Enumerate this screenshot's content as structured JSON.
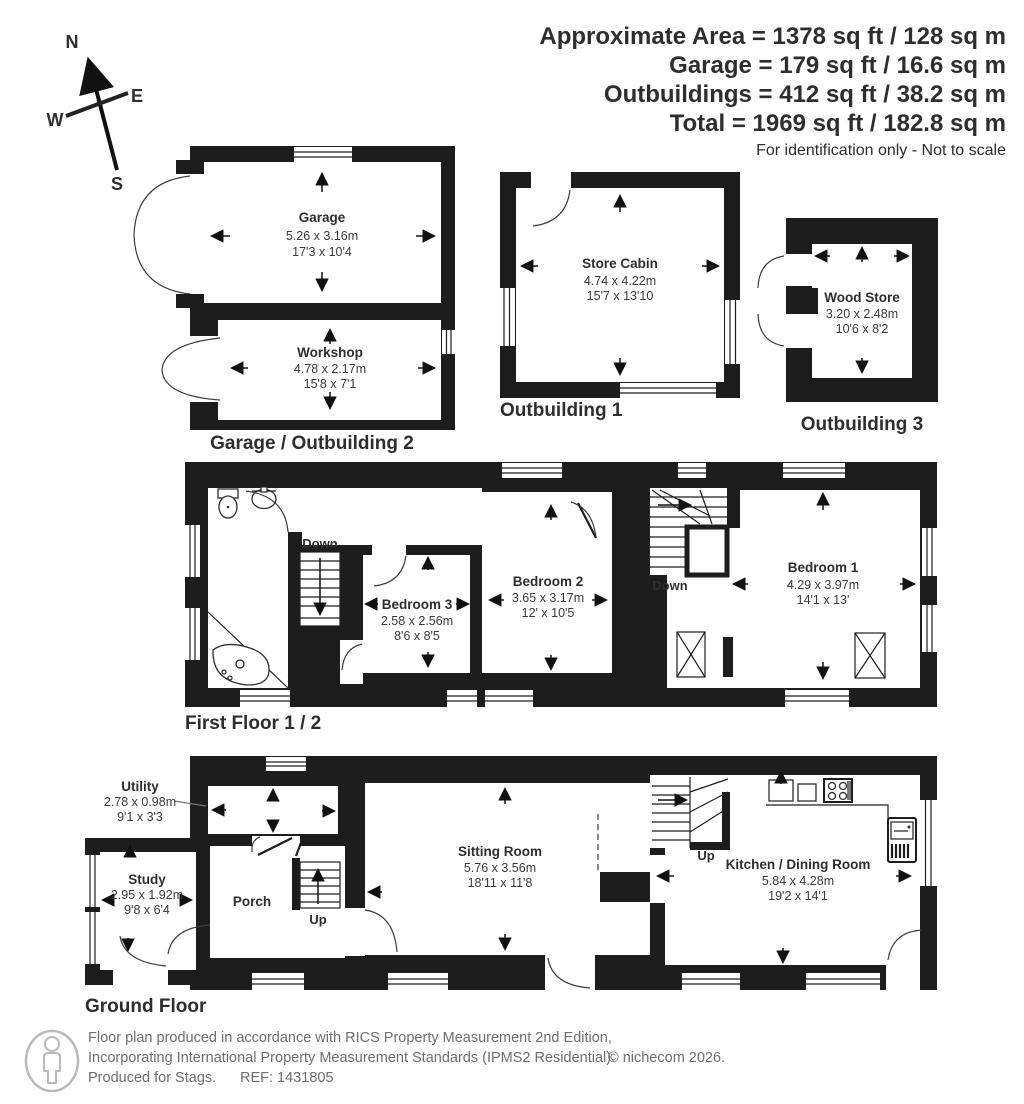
{
  "header": {
    "line1": "Approximate Area = 1378 sq ft / 128 sq m",
    "line2": "Garage = 179 sq ft / 16.6 sq m",
    "line3": "Outbuildings = 412 sq ft / 38.2 sq m",
    "line4": "Total = 1969 sq ft / 182.8 sq m",
    "disclaimer": "For identification only - Not to scale"
  },
  "compass": {
    "north": "N",
    "east": "E",
    "south": "S",
    "west": "W"
  },
  "garage_block": {
    "label": "Garage / Outbuilding 2",
    "garage": {
      "name": "Garage",
      "metric": "5.26 x 3.16m",
      "imperial": "17'3 x 10'4"
    },
    "workshop": {
      "name": "Workshop",
      "metric": "4.78 x 2.17m",
      "imperial": "15'8 x 7'1"
    }
  },
  "outbuilding1": {
    "label": "Outbuilding 1",
    "store_cabin": {
      "name": "Store Cabin",
      "metric": "4.74 x 4.22m",
      "imperial": "15'7 x 13'10"
    }
  },
  "outbuilding3": {
    "label": "Outbuilding 3",
    "wood_store": {
      "name": "Wood Store",
      "metric": "3.20 x 2.48m",
      "imperial": "10'6 x 8'2"
    }
  },
  "first_floor": {
    "label": "First Floor 1 / 2",
    "bedroom1": {
      "name": "Bedroom 1",
      "metric": "4.29 x 3.97m",
      "imperial": "14'1 x 13'"
    },
    "bedroom2": {
      "name": "Bedroom 2",
      "metric": "3.65 x 3.17m",
      "imperial": "12' x 10'5"
    },
    "bedroom3": {
      "name": "Bedroom 3",
      "metric": "2.58 x 2.56m",
      "imperial": "8'6 x 8'5"
    },
    "stairs_left": "Down",
    "stairs_right": "Down"
  },
  "ground_floor": {
    "label": "Ground Floor",
    "utility": {
      "name": "Utility",
      "metric": "2.78 x 0.98m",
      "imperial": "9'1 x 3'3"
    },
    "study": {
      "name": "Study",
      "metric": "2.95 x 1.92m",
      "imperial": "9'8 x 6'4"
    },
    "porch": {
      "name": "Porch"
    },
    "sitting_room": {
      "name": "Sitting Room",
      "metric": "5.76 x 3.56m",
      "imperial": "18'11 x 11'8"
    },
    "kitchen": {
      "name": "Kitchen / Dining Room",
      "metric": "5.84 x 4.28m",
      "imperial": "19'2 x 14'1"
    },
    "stairs_porch": "Up",
    "stairs_kitchen": "Up"
  },
  "footer": {
    "line1": "Floor plan produced in accordance with RICS Property Measurement 2nd Edition,",
    "line2": "Incorporating International Property Measurement Standards (IPMS2 Residential).",
    "copyright": "© nichecom 2026.",
    "produced": "Produced for Stags.",
    "ref": "REF: 1431805"
  },
  "colors": {
    "wall": "#1d1d1d",
    "text": "#2e2e2e",
    "muted": "#6e6e6e"
  }
}
